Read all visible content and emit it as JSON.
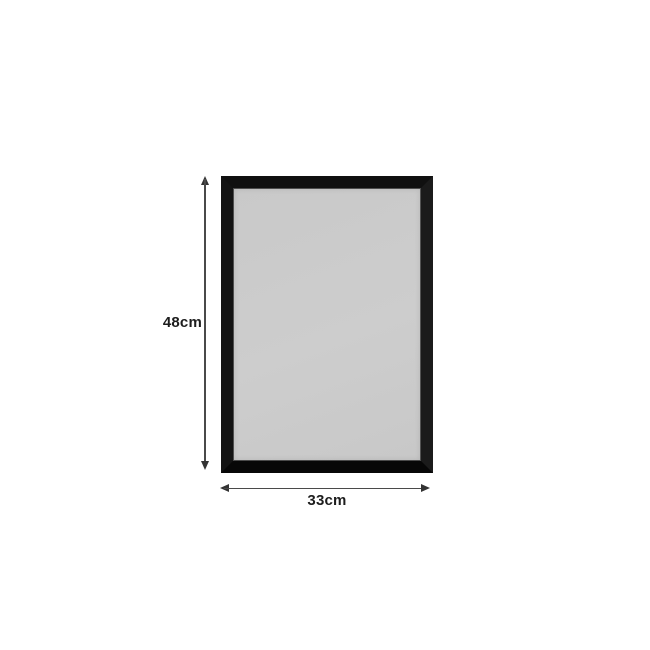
{
  "diagram": {
    "description": "black rectangular frame with light grey panel and dimension arrows",
    "height_dimension": {
      "label": "48cm"
    },
    "width_dimension": {
      "label": "33cm"
    }
  },
  "colors": {
    "background": "#ffffff",
    "frame": "#101010",
    "panel": "#cbcbcb",
    "arrow": "#4a4a4a",
    "arrowhead": "#333333",
    "text": "#1d1d1d"
  }
}
